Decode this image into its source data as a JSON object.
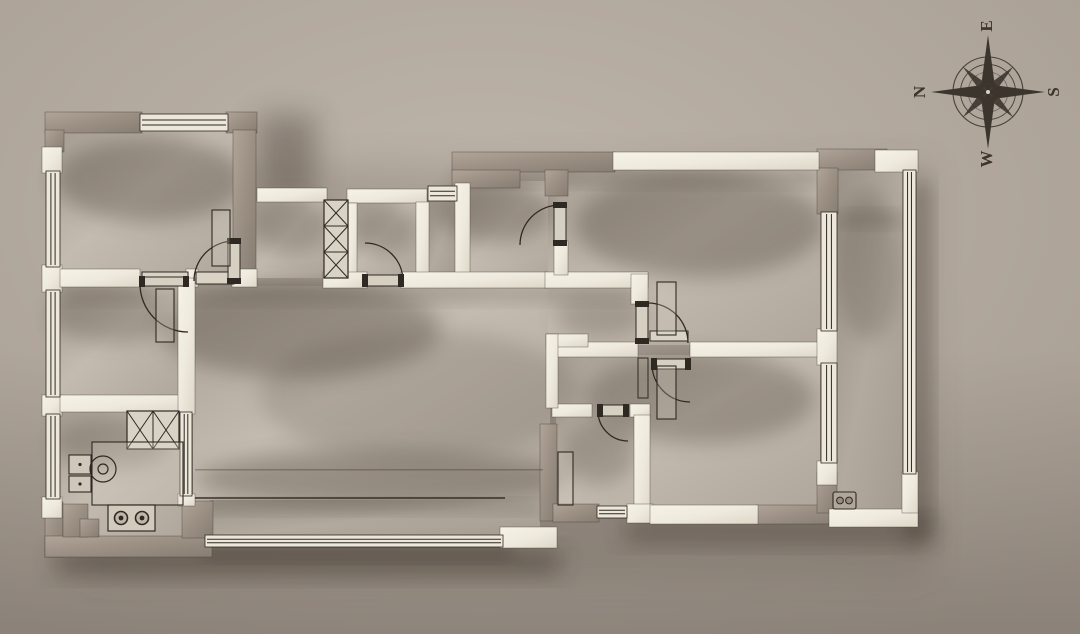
{
  "canvas": {
    "w": 1080,
    "h": 634
  },
  "palette": {
    "background_center": "#bdb4aa",
    "background_edge": "#a79d93",
    "wall_taupe_light": "#b0a598",
    "wall_taupe": "#9c9184",
    "wall_taupe_dark": "#877d71",
    "wall_white_light": "#f6f2e6",
    "wall_white": "#efeade",
    "wall_white_dark": "#ddd7c8",
    "floor_dark": "#a89f93",
    "floor": "#c4bbb0",
    "floor_mid": "#b0a79c",
    "balcony_dark": "#9c9388",
    "balcony": "#b3aa9f",
    "balcony_mid": "#a49b90",
    "line": "#2e2922",
    "wall_outline": "#453e35",
    "compass": "#3b352d",
    "shadow": "#352c22"
  },
  "compass": {
    "cx": 988,
    "cy": 92,
    "labels": {
      "top": "E",
      "right": "S",
      "bottom": "W",
      "left": "N"
    },
    "radii": {
      "outer": 35,
      "mid": 27.5,
      "inner": 20,
      "long": 57,
      "short": 36
    },
    "label_offset": 66,
    "font_size": 17,
    "rotation_deg": -90
  },
  "plan": {
    "shadows": [
      {
        "n": "shadow-plan-ambient",
        "r": [
          80,
          165,
          850,
          410
        ],
        "op": 0.14,
        "blur": 18
      },
      {
        "n": "shadow-bottom-left",
        "r": [
          55,
          550,
          505,
          24
        ],
        "op": 0.45,
        "blur": 12
      },
      {
        "n": "shadow-bottom-right",
        "r": [
          625,
          520,
          300,
          22
        ],
        "op": 0.4,
        "blur": 12
      },
      {
        "n": "shadow-right-rail",
        "r": [
          913,
          182,
          16,
          338
        ],
        "op": 0.4,
        "blur": 10
      },
      {
        "n": "shadow-notch",
        "r": [
          258,
          115,
          58,
          82
        ],
        "op": 0.35,
        "blur": 14
      },
      {
        "n": "shadow-se-corner",
        "r": [
          905,
          512,
          30,
          32
        ],
        "op": 0.35,
        "blur": 10
      },
      {
        "n": "shadow-balcony-window",
        "r": [
          205,
          546,
          308,
          12
        ],
        "op": 0.35,
        "blur": 8
      }
    ],
    "floors": [
      {
        "n": "floor-bedroom1",
        "r": [
          60,
          128,
          176,
          148
        ],
        "t": "room"
      },
      {
        "n": "floor-bedroom2",
        "r": [
          58,
          285,
          122,
          113
        ],
        "t": "room"
      },
      {
        "n": "floor-kitchen",
        "r": [
          58,
          410,
          124,
          128
        ],
        "t": "room"
      },
      {
        "n": "floor-corridor",
        "r": [
          255,
          200,
          72,
          78
        ],
        "t": "room"
      },
      {
        "n": "floor-bath1",
        "r": [
          355,
          201,
          62,
          74
        ],
        "t": "room"
      },
      {
        "n": "floor-niche",
        "r": [
          428,
          202,
          28,
          74
        ],
        "t": "balcony"
      },
      {
        "n": "floor-entry",
        "r": [
          468,
          181,
          88,
          93
        ],
        "t": "room"
      },
      {
        "n": "floor-living",
        "r": [
          193,
          286,
          357,
          216
        ],
        "t": "room"
      },
      {
        "n": "floor-balcony-south",
        "r": [
          210,
          500,
          330,
          38
        ],
        "t": "balcony"
      },
      {
        "n": "floor-top-right-zone",
        "r": [
          548,
          168,
          274,
          177
        ],
        "t": "room"
      },
      {
        "n": "floor-bottom-right-zone",
        "r": [
          556,
          355,
          264,
          152
        ],
        "t": "room"
      },
      {
        "n": "floor-balcony-east",
        "r": [
          837,
          170,
          68,
          341
        ],
        "t": "balcony"
      }
    ],
    "ao_ellipses": [
      [
        150,
        180,
        95,
        42,
        0.3
      ],
      [
        112,
        315,
        62,
        28,
        0.25
      ],
      [
        112,
        442,
        58,
        26,
        0.25
      ],
      [
        290,
        225,
        40,
        28,
        0.25
      ],
      [
        385,
        230,
        32,
        24,
        0.25
      ],
      [
        495,
        212,
        58,
        30,
        0.3
      ],
      [
        300,
        330,
        140,
        48,
        0.28
      ],
      [
        420,
        395,
        160,
        65,
        0.15
      ],
      [
        380,
        478,
        185,
        28,
        0.28
      ],
      [
        700,
        225,
        125,
        52,
        0.3
      ],
      [
        700,
        398,
        115,
        45,
        0.28
      ],
      [
        598,
        452,
        38,
        32,
        0.25
      ],
      [
        868,
        265,
        32,
        75,
        0.2
      ],
      [
        600,
        315,
        45,
        22,
        0.22
      ]
    ],
    "ao_rects": [
      [
        613,
        170,
        206,
        14,
        0.25
      ],
      [
        455,
        172,
        160,
        12,
        0.25
      ],
      [
        60,
        287,
        580,
        14,
        0.2
      ],
      [
        203,
        502,
        337,
        10,
        0.2
      ],
      [
        838,
        213,
        66,
        12,
        0.22
      ]
    ],
    "walls_taupe": [
      {
        "n": "wall-bedroom1-top",
        "r": [
          45,
          112,
          97,
          21
        ]
      },
      {
        "n": "wall-bedroom1-top-corner",
        "r": [
          226,
          112,
          31,
          21
        ]
      },
      {
        "n": "wall-bedroom1-right",
        "r": [
          233,
          130,
          23,
          146
        ]
      },
      {
        "n": "wall-left-top-corner",
        "r": [
          45,
          130,
          19,
          22
        ]
      },
      {
        "n": "wall-entry-top",
        "r": [
          452,
          152,
          163,
          20
        ]
      },
      {
        "n": "wall-entry-top-deep",
        "r": [
          452,
          170,
          68,
          18
        ]
      },
      {
        "n": "wall-entry-stub",
        "r": [
          545,
          170,
          23,
          26
        ]
      },
      {
        "n": "wall-ne-corner-h",
        "r": [
          817,
          149,
          70,
          21
        ]
      },
      {
        "n": "wall-ne-corner-v",
        "r": [
          817,
          168,
          21,
          46
        ]
      },
      {
        "n": "wall-kitchen-left-bottom",
        "r": [
          45,
          502,
          18,
          55
        ]
      },
      {
        "n": "wall-kitchen-bottom",
        "r": [
          45,
          536,
          167,
          21
        ]
      },
      {
        "n": "wall-kitchen-step1",
        "r": [
          63,
          504,
          25,
          33
        ]
      },
      {
        "n": "wall-kitchen-step2",
        "r": [
          80,
          519,
          19,
          18
        ]
      },
      {
        "n": "wall-balcony-west",
        "r": [
          182,
          501,
          31,
          37
        ]
      },
      {
        "n": "wall-bath2-left",
        "r": [
          540,
          424,
          17,
          97
        ]
      },
      {
        "n": "wall-bath2-bottom",
        "r": [
          553,
          504,
          46,
          18
        ]
      },
      {
        "n": "wall-bedroom3-bottom",
        "r": [
          756,
          505,
          81,
          19
        ]
      },
      {
        "n": "wall-bedroom3-corner",
        "r": [
          817,
          472,
          20,
          41
        ]
      }
    ],
    "walls_white": [
      {
        "n": "wall-cap-left-1",
        "r": [
          42,
          147,
          20,
          26
        ]
      },
      {
        "n": "wall-cap-left-2",
        "r": [
          42,
          265,
          20,
          27
        ]
      },
      {
        "n": "wall-cap-left-3",
        "r": [
          42,
          395,
          20,
          21
        ]
      },
      {
        "n": "wall-cap-left-4",
        "r": [
          42,
          497,
          20,
          21
        ]
      },
      {
        "n": "wall-divider-west",
        "r": [
          60,
          269,
          80,
          18
        ]
      },
      {
        "n": "wall-divider-mid",
        "r": [
          186,
          269,
          12,
          18
        ]
      },
      {
        "n": "wall-divider-corner",
        "r": [
          232,
          269,
          25,
          18
        ]
      },
      {
        "n": "wall-kitchen-top",
        "r": [
          60,
          395,
          133,
          17
        ]
      },
      {
        "n": "wall-left-divider",
        "r": [
          178,
          278,
          17,
          136
        ]
      },
      {
        "n": "wall-left-divider-cap",
        "r": [
          178,
          494,
          17,
          12
        ]
      },
      {
        "n": "wall-corridor-top",
        "r": [
          257,
          188,
          70,
          14
        ]
      },
      {
        "n": "wall-bath1-top",
        "r": [
          347,
          189,
          80,
          14
        ]
      },
      {
        "n": "wall-bath1-left",
        "r": [
          347,
          203,
          10,
          76
        ]
      },
      {
        "n": "wall-bath1-right",
        "r": [
          416,
          202,
          13,
          77
        ]
      },
      {
        "n": "wall-entry-west",
        "r": [
          455,
          183,
          15,
          97
        ]
      },
      {
        "n": "wall-living-top-a",
        "r": [
          323,
          272,
          44,
          16
        ]
      },
      {
        "n": "wall-living-top-b",
        "r": [
          401,
          272,
          146,
          16
        ]
      },
      {
        "n": "wall-living-top-c",
        "r": [
          545,
          272,
          103,
          16
        ]
      },
      {
        "n": "wall-entry-door-below",
        "r": [
          554,
          241,
          14,
          34
        ]
      },
      {
        "n": "wall-top-right",
        "r": [
          613,
          152,
          206,
          18
        ]
      },
      {
        "n": "wall-ne-cap",
        "r": [
          875,
          150,
          43,
          22
        ]
      },
      {
        "n": "wall-tr-room-left",
        "r": [
          631,
          274,
          17,
          30
        ]
      },
      {
        "n": "wall-mid-h-west",
        "r": [
          552,
          342,
          86,
          15
        ]
      },
      {
        "n": "wall-mid-h-east",
        "r": [
          690,
          342,
          140,
          15
        ]
      },
      {
        "n": "wall-right-divider-cap",
        "r": [
          817,
          329,
          20,
          36
        ]
      },
      {
        "n": "wall-bath2-top-west",
        "r": [
          552,
          404,
          40,
          13
        ]
      },
      {
        "n": "wall-bath2-top-east",
        "r": [
          630,
          404,
          20,
          13
        ]
      },
      {
        "n": "wall-bath2-right",
        "r": [
          634,
          415,
          16,
          106
        ]
      },
      {
        "n": "wall-bath2-corner",
        "r": [
          627,
          504,
          26,
          19
        ]
      },
      {
        "n": "wall-bottom-white",
        "r": [
          650,
          505,
          108,
          19
        ]
      },
      {
        "n": "wall-right-cap-2",
        "r": [
          817,
          461,
          20,
          24
        ]
      },
      {
        "n": "wall-balcony-bottom-east",
        "r": [
          829,
          509,
          89,
          18
        ]
      },
      {
        "n": "wall-balcony-se",
        "r": [
          902,
          472,
          16,
          41
        ]
      },
      {
        "n": "wall-balcony-sw-corner",
        "r": [
          500,
          527,
          57,
          21
        ]
      },
      {
        "n": "wall-lstub-h",
        "r": [
          546,
          334,
          42,
          13
        ]
      },
      {
        "n": "wall-lstub-v",
        "r": [
          546,
          334,
          12,
          74
        ]
      }
    ],
    "windows": [
      {
        "n": "window-bedroom1-top",
        "r": [
          140,
          114,
          88,
          17
        ],
        "o": "h"
      },
      {
        "n": "window-left-1",
        "r": [
          46,
          171,
          14,
          96
        ],
        "o": "v"
      },
      {
        "n": "window-left-2",
        "r": [
          46,
          290,
          14,
          107
        ],
        "o": "v"
      },
      {
        "n": "window-left-3",
        "r": [
          46,
          414,
          14,
          85
        ],
        "o": "v"
      },
      {
        "n": "window-kitchen-slider",
        "r": [
          180,
          412,
          12,
          84
        ],
        "o": "v"
      },
      {
        "n": "window-entry-small",
        "r": [
          428,
          186,
          29,
          15
        ],
        "o": "h"
      },
      {
        "n": "window-right-1",
        "r": [
          821,
          212,
          16,
          119
        ],
        "o": "v"
      },
      {
        "n": "window-right-2",
        "r": [
          821,
          363,
          16,
          100
        ],
        "o": "v"
      },
      {
        "n": "window-balcony-rail",
        "r": [
          903,
          170,
          13,
          304
        ],
        "o": "v"
      },
      {
        "n": "window-balcony-south",
        "r": [
          205,
          535,
          298,
          12
        ],
        "o": "h"
      },
      {
        "n": "window-bath2-south",
        "r": [
          597,
          506,
          30,
          12
        ],
        "o": "h"
      }
    ],
    "doors": [
      {
        "n": "door-bedroom1",
        "leaf": [
          228,
          239,
          12,
          44
        ],
        "arc": [
          234,
          241,
          194,
          281,
          40,
          0
        ],
        "thr": [
          196,
          272,
          38,
          12
        ]
      },
      {
        "n": "door-bedroom2",
        "leaf": [
          140,
          277,
          48,
          9
        ],
        "arc": [
          140,
          284,
          188,
          332,
          48,
          0
        ],
        "thr": [
          142,
          272,
          46,
          12
        ]
      },
      {
        "n": "door-bath1",
        "leaf": [
          363,
          275,
          40,
          11
        ],
        "arc": [
          365,
          243,
          403,
          281,
          38,
          1
        ]
      },
      {
        "n": "door-entry",
        "leaf": [
          554,
          203,
          12,
          42
        ],
        "arc": [
          560,
          205,
          520,
          245,
          40,
          0
        ]
      },
      {
        "n": "door-tr-room",
        "leaf": [
          636,
          302,
          12,
          41
        ],
        "arc": [
          648,
          303,
          688,
          343,
          40,
          1
        ],
        "thr": [
          650,
          331,
          38,
          10
        ]
      },
      {
        "n": "door-br-room",
        "leaf": [
          652,
          359,
          38,
          10
        ],
        "arc": [
          652,
          364,
          690,
          402,
          38,
          0
        ],
        "bar": [
          638,
          358,
          10,
          40
        ]
      },
      {
        "n": "door-bath2",
        "leaf": [
          598,
          405,
          30,
          11
        ],
        "arc": [
          598,
          411,
          628,
          441,
          30,
          0
        ]
      }
    ],
    "fixtures": [
      {
        "n": "closet-shaft",
        "type": "xbox",
        "r": [
          324,
          200,
          24,
          78
        ],
        "cells": 3,
        "o": "v"
      },
      {
        "n": "kitchen-cabinet",
        "type": "xbox",
        "r": [
          127,
          411,
          52,
          38
        ],
        "cells": 2,
        "o": "h"
      },
      {
        "n": "wardrobe-bedroom1",
        "type": "rect",
        "r": [
          212,
          210,
          18,
          56
        ]
      },
      {
        "n": "wardrobe-bedroom2",
        "type": "rect",
        "r": [
          156,
          289,
          18,
          53
        ]
      },
      {
        "n": "wardrobe-tr-room",
        "type": "rect",
        "r": [
          657,
          282,
          19,
          53
        ]
      },
      {
        "n": "wardrobe-br-room",
        "type": "rect",
        "r": [
          657,
          366,
          19,
          53
        ]
      },
      {
        "n": "kitchen-counter",
        "type": "rect",
        "r": [
          92,
          442,
          91,
          63
        ]
      },
      {
        "n": "kitchen-sink-upper",
        "type": "box",
        "r": [
          69,
          455,
          22,
          19
        ]
      },
      {
        "n": "kitchen-sink-lower",
        "type": "box",
        "r": [
          69,
          476,
          22,
          16
        ]
      },
      {
        "n": "kitchen-stool",
        "type": "circle",
        "c": [
          103,
          469,
          13
        ]
      },
      {
        "n": "kitchen-stool-inner",
        "type": "circle",
        "c": [
          103,
          469,
          5
        ]
      },
      {
        "n": "stove",
        "type": "stove",
        "r": [
          108,
          505,
          47,
          26
        ]
      },
      {
        "n": "bath2-vanity",
        "type": "rect",
        "r": [
          558,
          452,
          15,
          53
        ]
      },
      {
        "n": "outlet",
        "type": "outlet",
        "r": [
          833,
          492,
          23,
          17
        ]
      },
      {
        "n": "floor-step-line",
        "type": "line",
        "r": [
          195,
          497,
          310,
          2
        ],
        "op": 0.7
      },
      {
        "n": "floor-line",
        "type": "line",
        "r": [
          195,
          469,
          348,
          1.5
        ],
        "op": 0.3
      }
    ]
  }
}
